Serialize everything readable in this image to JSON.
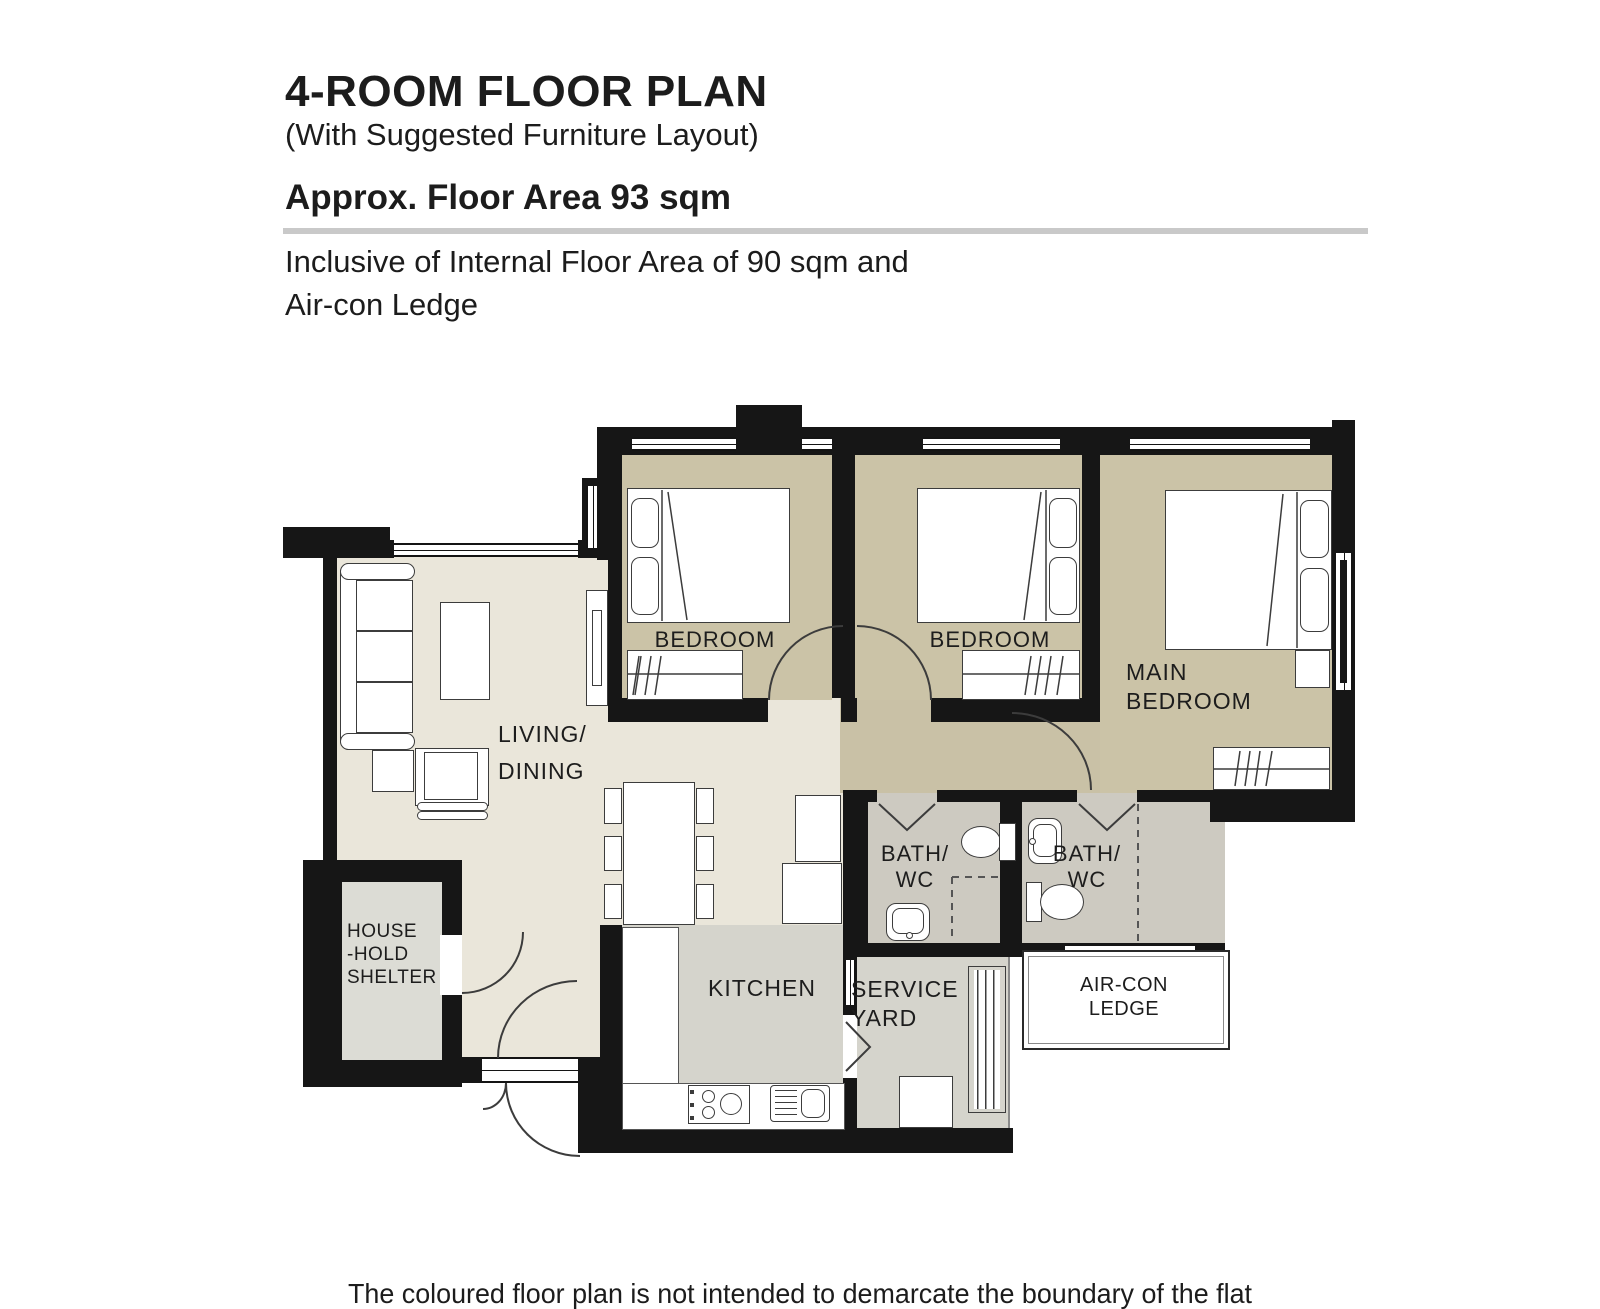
{
  "header": {
    "title": "4-ROOM FLOOR PLAN",
    "subtitle": "(With Suggested Furniture Layout)",
    "area_line": "Approx. Floor Area 93 sqm",
    "note_line1": "Inclusive of Internal Floor Area of 90 sqm and",
    "note_line2": "Air-con Ledge"
  },
  "footer": {
    "disclaimer": "The coloured floor plan is not intended to demarcate the boundary of the flat"
  },
  "rooms": {
    "bedroom1": {
      "label": "BEDROOM"
    },
    "bedroom2": {
      "label": "BEDROOM"
    },
    "main_bedroom": {
      "line1": "MAIN",
      "line2": "BEDROOM"
    },
    "living": {
      "line1": "LIVING/",
      "line2": "DINING"
    },
    "shelter": {
      "line1": "HOUSE",
      "line2": "-HOLD",
      "line3": "SHELTER"
    },
    "kitchen": {
      "label": "KITCHEN"
    },
    "service_yard": {
      "line1": "SERVICE",
      "line2": "YARD"
    },
    "bath1": {
      "line1": "BATH/",
      "line2": "WC"
    },
    "bath2": {
      "line1": "BATH/",
      "line2": "WC"
    },
    "aircon": {
      "line1": "AIR-CON",
      "line2": "LEDGE"
    }
  },
  "colors": {
    "wall": "#161616",
    "bedroom_floor": "#cbc3a7",
    "living_floor": "#eae6da",
    "corridor_floor": "#c9c1a6",
    "kitchen_floor": "#d5d4cc",
    "bath_floor": "#cdcac1",
    "shelter_floor": "#dcdcd5",
    "rule": "#c9c9c9"
  }
}
